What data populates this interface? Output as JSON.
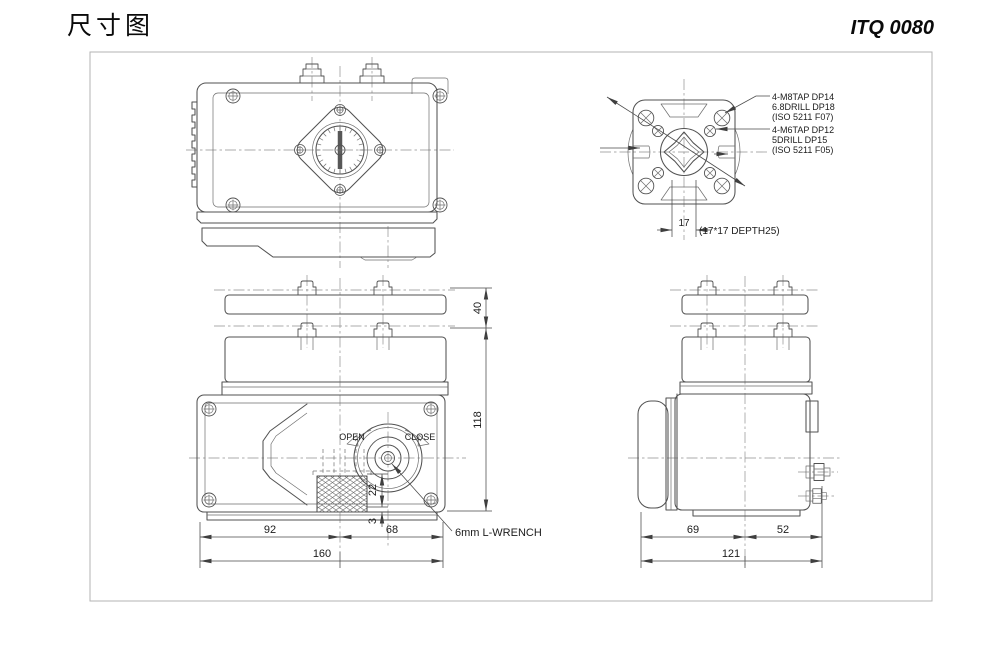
{
  "page": {
    "title": "尺寸图",
    "model": "ITQ 0080"
  },
  "flange_view": {
    "note1": {
      "l1": "4-M8TAP DP14",
      "l2": "6.8DRILL DP18",
      "l3": "(ISO 5211 F07)"
    },
    "note2": {
      "l1": "4-M6TAP DP12",
      "l2": "5DRILL DP15",
      "l3": "(ISO 5211 F05)"
    },
    "dim_square": "17",
    "socket_note": "(17*17 DEPTH25)"
  },
  "front_view": {
    "open_label": "OPEN",
    "close_label": "CLOSE",
    "wrench_note": "6mm L-WRENCH",
    "dims": {
      "left": "92",
      "right": "68",
      "total": "160",
      "shaft_height": "22",
      "base": "3",
      "cover": "40",
      "body": "118"
    }
  },
  "side_view": {
    "dims": {
      "left": "69",
      "right": "52",
      "total": "121"
    }
  }
}
